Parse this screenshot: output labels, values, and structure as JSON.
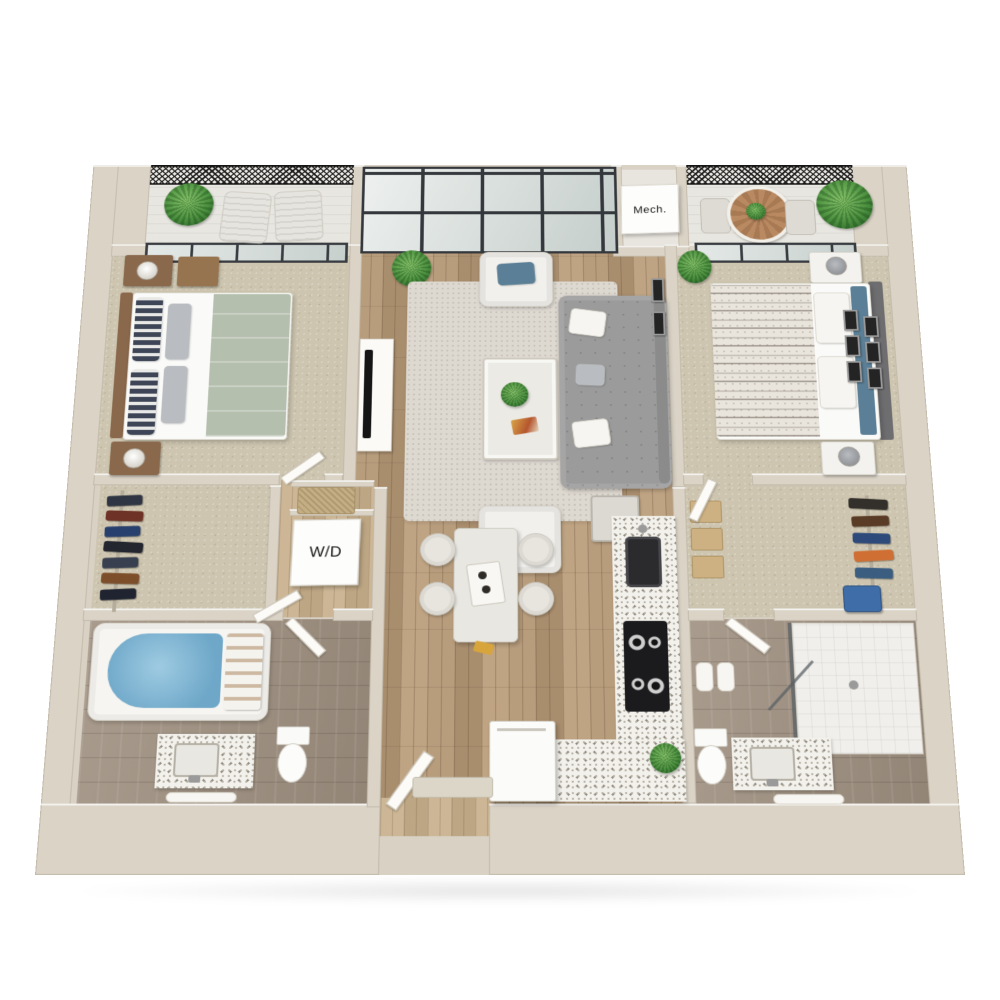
{
  "title": "3D two-bedroom apartment floor plan",
  "labels": {
    "mech_room": "Mech.",
    "washer_dryer": "W/D"
  },
  "palette": {
    "background": "#ffffff",
    "wall": "#dad3c6",
    "wall_top_highlight": "#f7f5f0",
    "wood_floor": "#b2977a",
    "hall_wood_floor": "#c6b08f",
    "carpet": "#cdc5af",
    "bathroom_tile": "#9f9080",
    "balcony_floor": "#e8e6e0",
    "railing_mesh": "#1f1f1f",
    "window_frame": "#393d41",
    "window_glass": "#d7dddb",
    "rug": "#ddd8d0",
    "sofa": "#9b9b9b",
    "accent_pillow_blue": "#5b7f96",
    "plant_green": "#4c9140",
    "tub_water_blue": "#7db7d6",
    "counter_speckle": "#f3f1eb",
    "appliance_black": "#1b1b1d",
    "wood_furniture": "#8a684c",
    "balcony_table_wood": "#b98a62",
    "suitcase_blue": "#3f6da8"
  }
}
